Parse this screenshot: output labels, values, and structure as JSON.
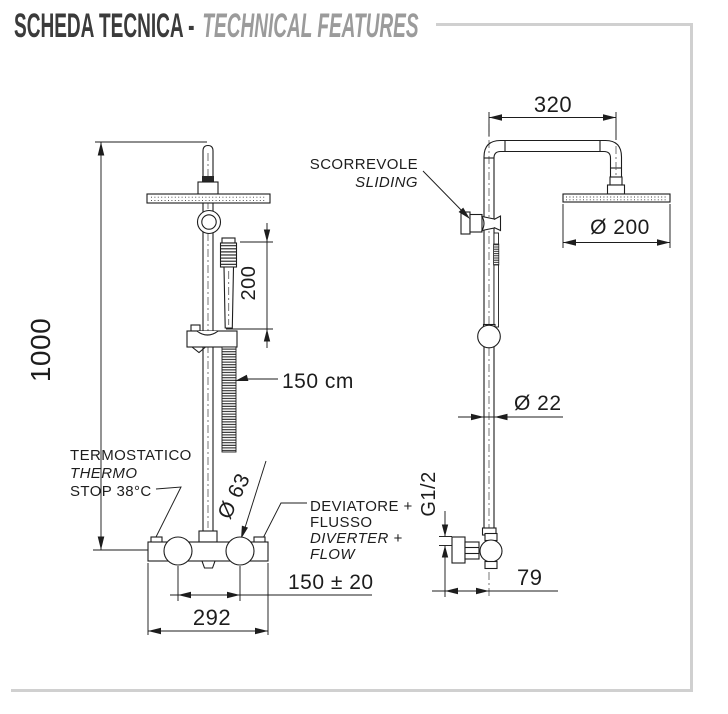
{
  "title": {
    "primary": "SCHEDA TECNICA -",
    "secondary": "TECHNICAL FEATURES"
  },
  "colors": {
    "line": "#1d1d1d",
    "frame": "#d0d0d0",
    "title_primary": "#3b3b3b",
    "title_secondary": "#9b9b9b"
  },
  "front_view": {
    "dims": {
      "total_height": "1000",
      "hand_shower_length": "200",
      "hose_length": "150 cm",
      "knob_diameter": "Ø 63",
      "inlet_distance": "150 ± 20",
      "body_width": "292"
    },
    "labels": {
      "thermostatic": [
        "TERMOSTATICO",
        "THERMO",
        "STOP 38°C"
      ],
      "diverter": [
        "DEVIATORE +",
        "FLUSSO",
        "DIVERTER +",
        "FLOW"
      ]
    }
  },
  "side_view": {
    "dims": {
      "arm_reach": "320",
      "head_diameter": "Ø 200",
      "column_diameter": "Ø 22",
      "connection_thread": "G1/2",
      "wall_distance": "79"
    },
    "labels": {
      "sliding": [
        "SCORREVOLE",
        "SLIDING"
      ]
    }
  }
}
